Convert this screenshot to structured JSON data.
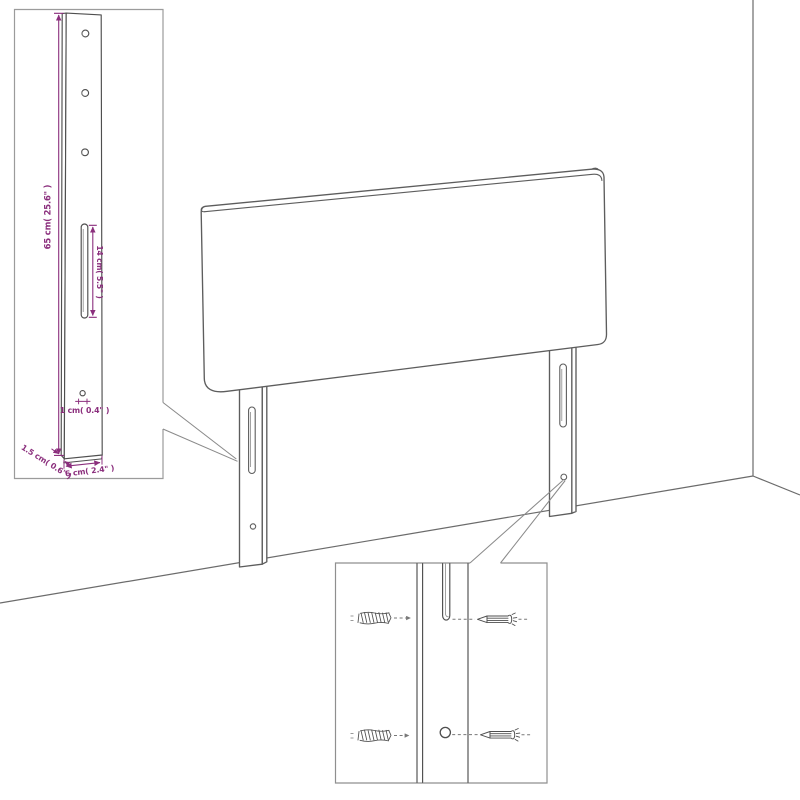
{
  "diagram_type": "headboard-wall-mounting-diagram",
  "labels": {
    "leg_height": "65 cm( 25.6\" )",
    "slot_length": "14 cm( 5.5\" )",
    "hole_diameter": "1 cm( 0.4\" )",
    "leg_thickness": "1.5 cm( 0.6\" )",
    "leg_width": "6 cm( 2.4\" )"
  },
  "colors": {
    "background": "#ffffff",
    "drawing_line": "#5d5d5d",
    "inset_border": "#9b9b9b",
    "dimension_text": "#8b2f7d",
    "dashed_line": "#787878"
  },
  "icons": {
    "wall_plug": "wall-plug-icon",
    "screw": "screw-icon"
  }
}
